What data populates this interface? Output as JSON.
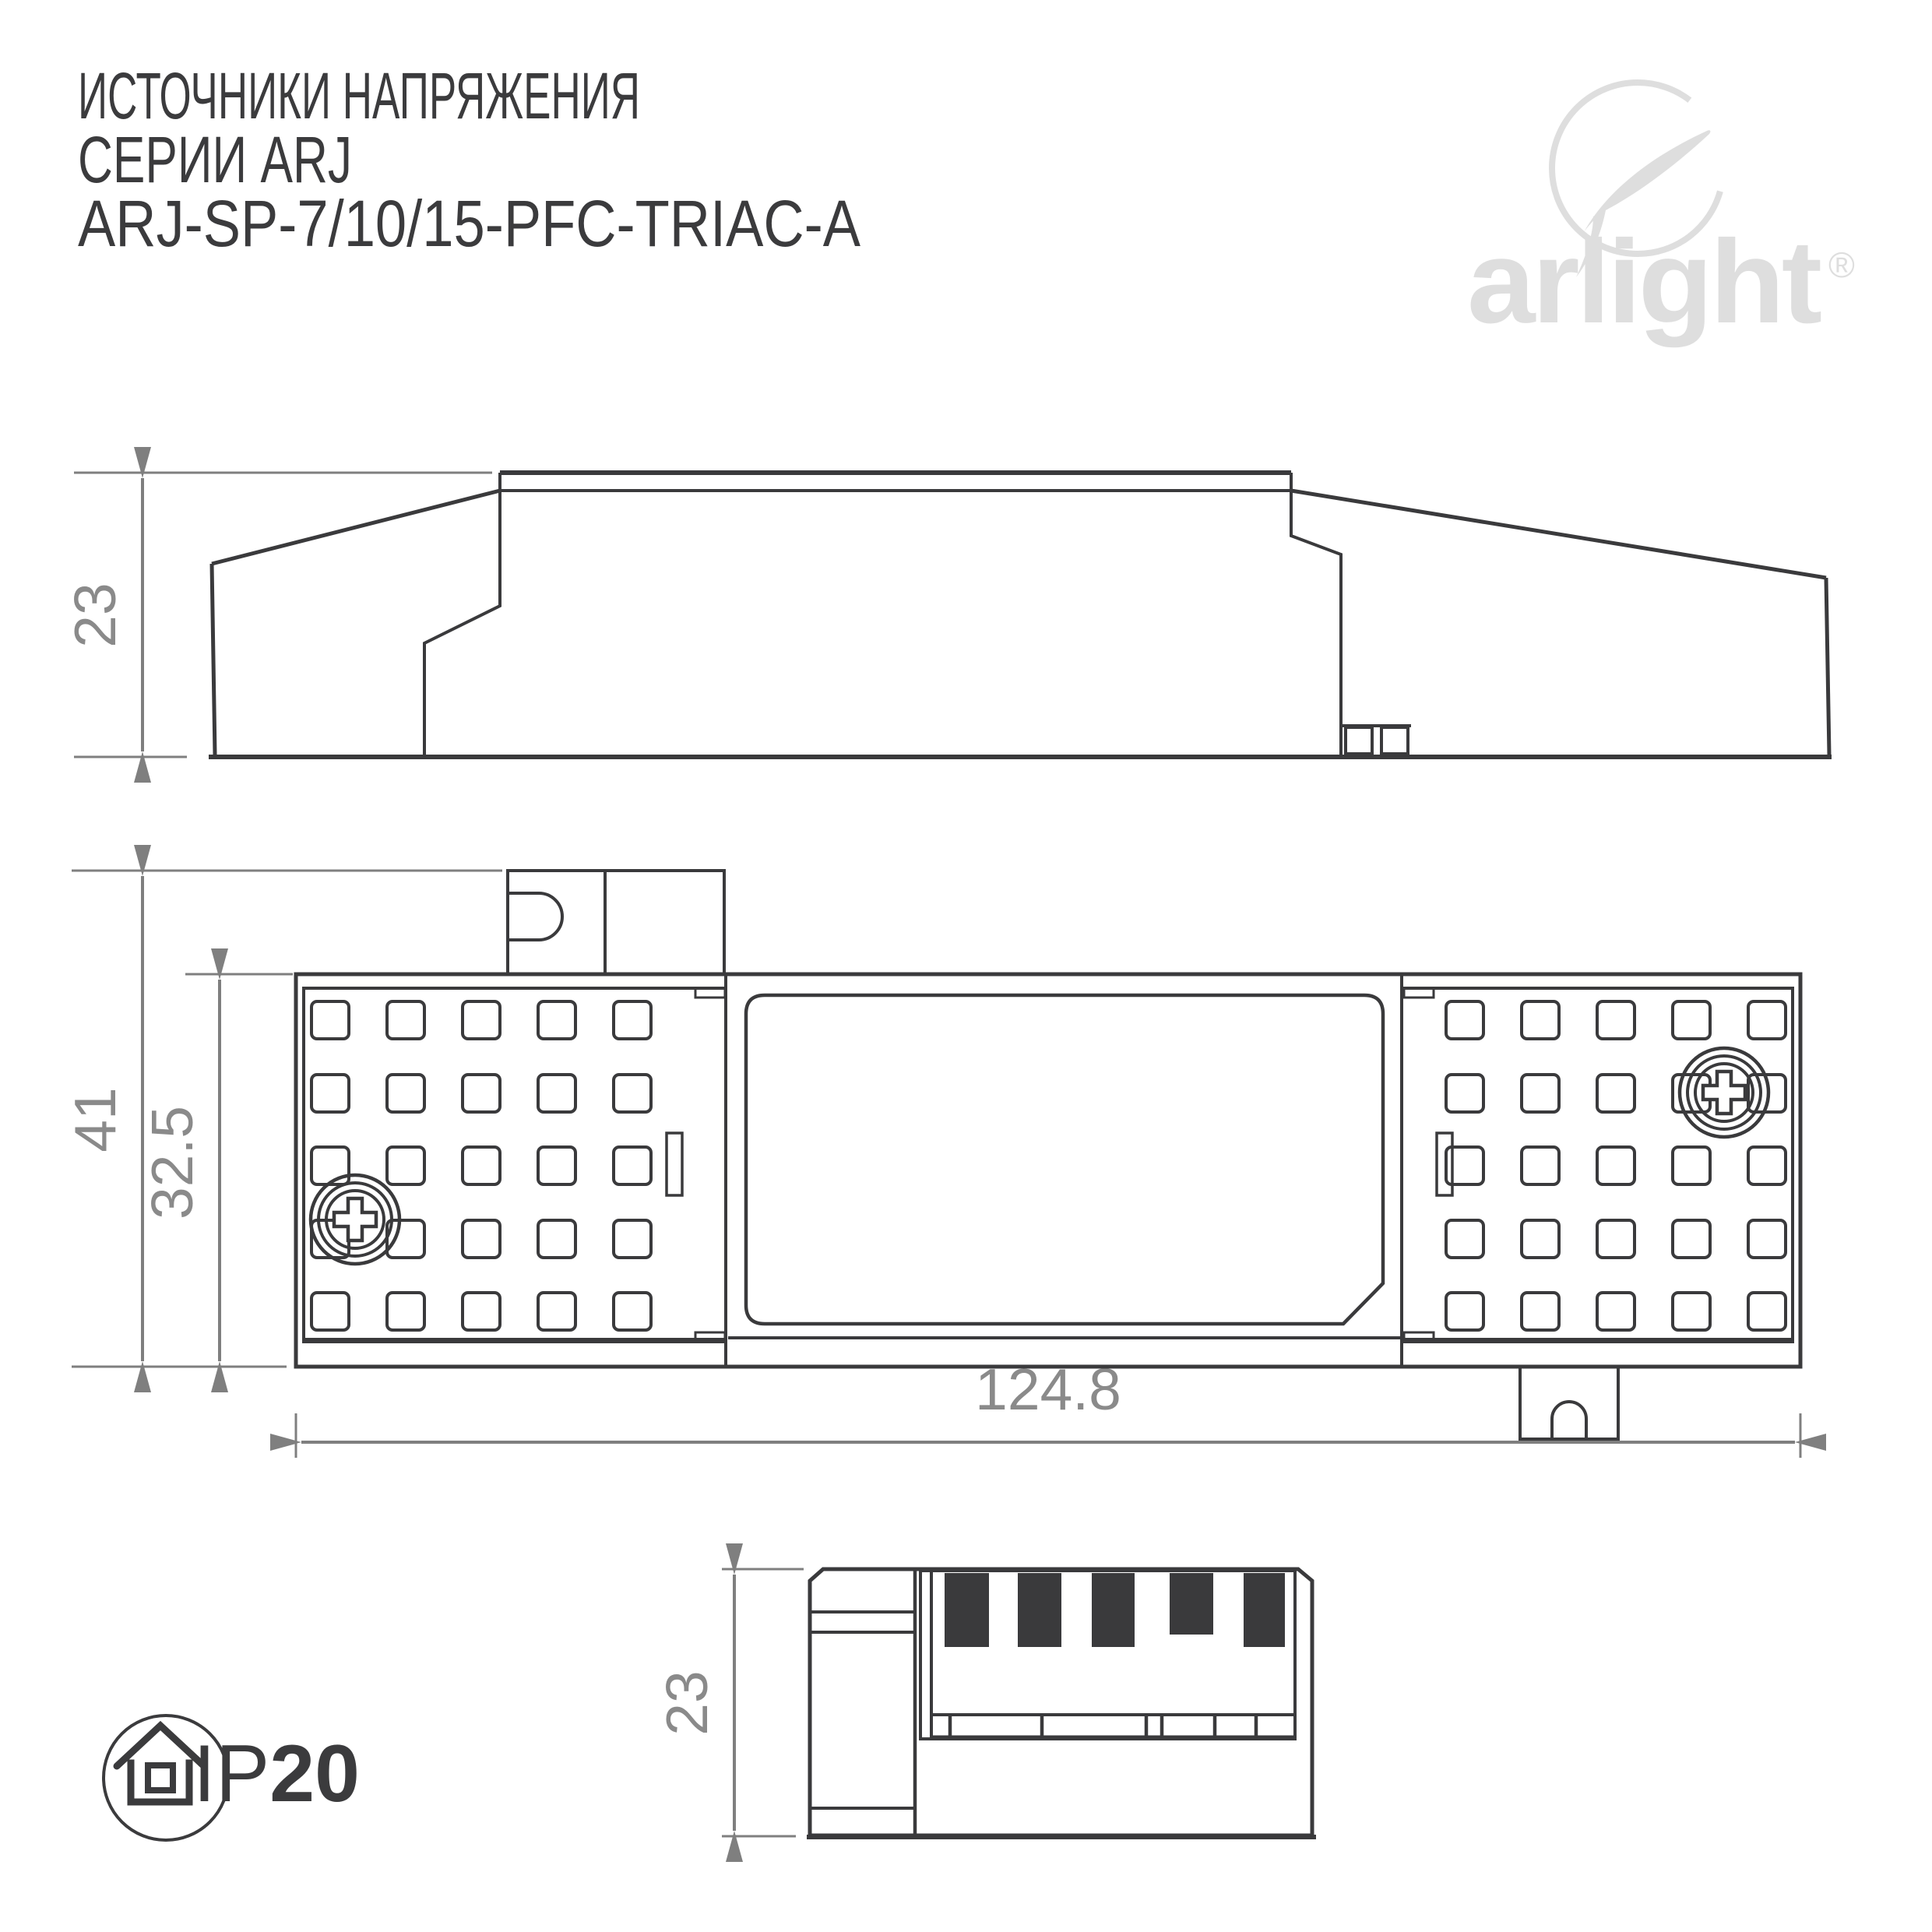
{
  "title": {
    "line1": "ИСТОЧНИКИ НАПРЯЖЕНИЯ",
    "line2": "СЕРИИ ARJ",
    "line3": "ARJ-SP-7/10/15-PFC-TRIAC-A"
  },
  "logo": {
    "text": "arlight",
    "registered": "®"
  },
  "views": {
    "side": {
      "height_label": "23"
    },
    "top": {
      "outer_height_label": "41",
      "inner_height_label": "32.5",
      "width_label": "124.8"
    },
    "end": {
      "height_label": "23"
    }
  },
  "badge": {
    "ip_prefix": "IP",
    "ip_value": "20"
  },
  "colors": {
    "line": "#3a3a3c",
    "dimension": "#7f7f7f",
    "dimension_text": "#8a8a8a",
    "title_text": "#3b3b3d",
    "logo": "#dedede",
    "background": "#ffffff"
  }
}
